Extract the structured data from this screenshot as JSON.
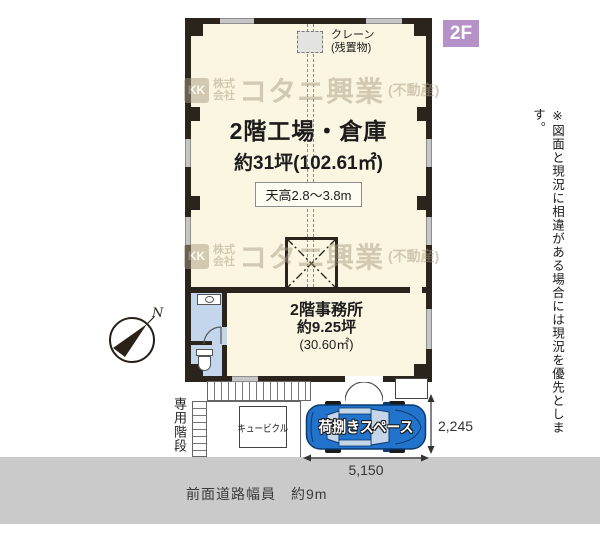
{
  "floor_badge": "2F",
  "compass": {
    "north_label": "N"
  },
  "watermark": {
    "logo_text": "KK",
    "company_prefix_1": "株式",
    "company_prefix_2": "会社",
    "company_name": "コタニ興業",
    "company_suffix": "(不動産)"
  },
  "factory": {
    "name": "2階工場・倉庫",
    "area": "約31坪(102.61㎡)",
    "ceiling_height": "天高2.8〜3.8m",
    "crane_label_line1": "クレーン",
    "crane_label_line2": "(残置物)"
  },
  "office": {
    "name": "2階事務所",
    "area_tsubo": "約9.25坪",
    "area_m2": "(30.60㎡)"
  },
  "exterior": {
    "stairs_label": "専用階段",
    "cubicle_label": "キュービクル",
    "loading_label": "荷捌きスペース",
    "dim_width": "5,150",
    "dim_depth": "2,245",
    "road_label": "前面道路幅員　約9m"
  },
  "disclaimer": "※図面と現況に相違がある場合には現況を優先とします。",
  "colors": {
    "floor": "#fbf6e1",
    "wall": "#2b241c",
    "wet_area": "#c3d6ec",
    "floor_badge_bg": "#b691c8",
    "road": "#cacaca",
    "car_body": "#2273cc",
    "watermark": "#a89d82"
  }
}
